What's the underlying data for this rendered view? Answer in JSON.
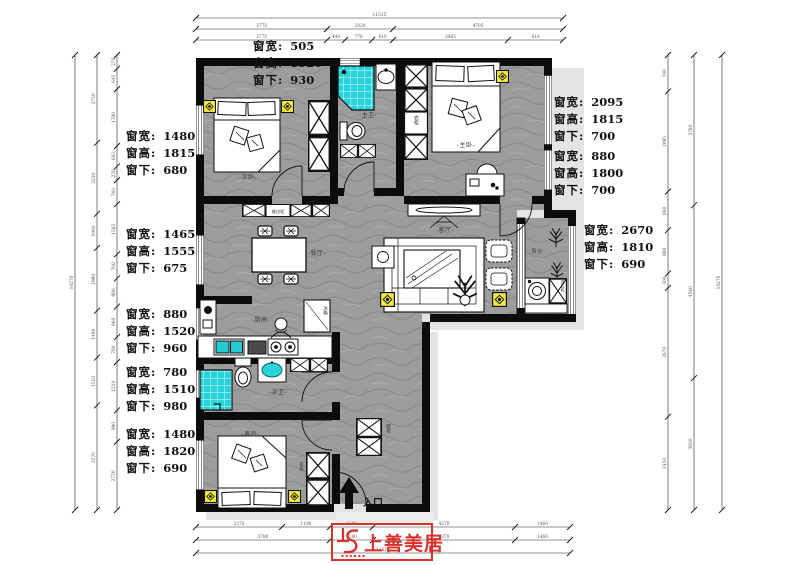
{
  "ann": {
    "labels": {
      "w": "窗宽:",
      "h": "窗高:",
      "b": "窗下:"
    },
    "top": {
      "w": "505",
      "h": "1520",
      "b": "930"
    },
    "left": [
      {
        "w": "1480",
        "h": "1815",
        "b": "680"
      },
      {
        "w": "1465",
        "h": "1555",
        "b": "675"
      },
      {
        "w": "880",
        "h": "1520",
        "b": "960"
      },
      {
        "w": "780",
        "h": "1510",
        "b": "980"
      },
      {
        "w": "1480",
        "h": "1820",
        "b": "690"
      }
    ],
    "right": [
      {
        "w": "2095",
        "h": "1815",
        "b": "700"
      },
      {
        "w": "880",
        "h": "1800",
        "b": "700"
      },
      {
        "w": "2670",
        "h": "1810",
        "b": "690"
      }
    ]
  },
  "rooms": {
    "bedroom2": "-次卧-",
    "master_bath": "-主卫-",
    "master_bed": "-主卧-",
    "dining": "-餐厅-",
    "living": "-客厅-",
    "balcony": "-阳台-",
    "kitchen": "-厨房-",
    "bath2": "-次卫-",
    "guest_bed": "-客卧-",
    "entry": "入口",
    "wardrobe": "衣柜",
    "wardrobe2": "衣柜",
    "shoe": "鞋柜",
    "sideboard": "餐边柜",
    "fridge": "冰箱",
    "washer": "洗衣机"
  },
  "logo": {
    "text": "上善美居"
  },
  "colors": {
    "wall": "#0c0c0c",
    "floor": "#9c9c9c",
    "mosaic": "#25d3da",
    "accent_yellow": "#f4ea3d",
    "logo_red": "#d8322e",
    "shadow": "#e4e4e4"
  },
  "dims": {
    "chains": [
      {
        "o": "h",
        "x": 196,
        "y": 18,
        "len": 367,
        "segs": [
          [
            "11515",
            1
          ]
        ]
      },
      {
        "o": "h",
        "x": 196,
        "y": 29,
        "len": 367,
        "segs": [
          [
            "3775",
            0.357
          ],
          [
            "2020",
            0.18
          ],
          [
            "4795",
            0.463
          ]
        ]
      },
      {
        "o": "h",
        "x": 196,
        "y": 40,
        "len": 367,
        "segs": [
          [
            "3775",
            0.357
          ],
          [
            "440",
            0.049
          ],
          [
            "770",
            0.074
          ],
          [
            "810",
            0.057
          ],
          [
            "3485",
            0.313
          ],
          [
            "810",
            0.15
          ]
        ]
      },
      {
        "o": "h",
        "x": 196,
        "y": 527,
        "len": 374,
        "segs": [
          [
            "2570",
            0.23
          ],
          [
            "1190",
            0.128
          ],
          [
            "1140",
            0.115
          ],
          [
            "4370",
            0.38
          ],
          [
            "1460",
            0.147
          ]
        ]
      },
      {
        "o": "h",
        "x": 196,
        "y": 540,
        "len": 374,
        "segs": [
          [
            "3780",
            0.358
          ],
          [
            "1140",
            0.115
          ],
          [
            "4370",
            0.38
          ],
          [
            "1460",
            0.147
          ]
        ]
      },
      {
        "o": "h",
        "x": 196,
        "y": 553,
        "len": 374,
        "segs": [
          [
            "11515",
            1
          ]
        ]
      },
      {
        "o": "v",
        "x": 75,
        "y": 55,
        "len": 455,
        "segs": [
          [
            "14270",
            1
          ]
        ]
      },
      {
        "o": "v",
        "x": 97,
        "y": 55,
        "len": 455,
        "segs": [
          [
            "2750",
            0.193
          ],
          [
            "2230",
            0.156
          ],
          [
            "1060",
            0.075
          ],
          [
            "1980",
            0.138
          ],
          [
            "1490",
            0.103
          ],
          [
            "1510",
            0.105
          ],
          [
            "3270",
            0.23
          ]
        ]
      },
      {
        "o": "v",
        "x": 117,
        "y": 55,
        "len": 455,
        "segs": [
          [
            "270",
            0.03
          ],
          [
            "645",
            0.045
          ],
          [
            "1780",
            0.125
          ],
          [
            "645",
            0.045
          ],
          [
            "270",
            0.03
          ],
          [
            "760",
            0.053
          ],
          [
            "1565",
            0.11
          ],
          [
            "760",
            0.053
          ],
          [
            "880",
            0.062
          ],
          [
            "960",
            0.067
          ],
          [
            "780",
            0.055
          ],
          [
            "1510",
            0.106
          ],
          [
            "980",
            0.069
          ],
          [
            "2770",
            0.15
          ]
        ]
      },
      {
        "o": "v",
        "x": 668,
        "y": 55,
        "len": 455,
        "segs": [
          [
            "740",
            0.08
          ],
          [
            "2095",
            0.22
          ],
          [
            "800",
            0.085
          ],
          [
            "880",
            0.095
          ],
          [
            "300",
            0.032
          ],
          [
            "2670",
            0.283
          ],
          [
            "2450",
            0.205
          ]
        ]
      },
      {
        "o": "v",
        "x": 694,
        "y": 55,
        "len": 455,
        "segs": [
          [
            "3780",
            0.33
          ],
          [
            "4560",
            0.38
          ],
          [
            "3930",
            0.29
          ]
        ]
      },
      {
        "o": "v",
        "x": 722,
        "y": 55,
        "len": 455,
        "segs": [
          [
            "14270",
            1
          ]
        ]
      }
    ]
  }
}
